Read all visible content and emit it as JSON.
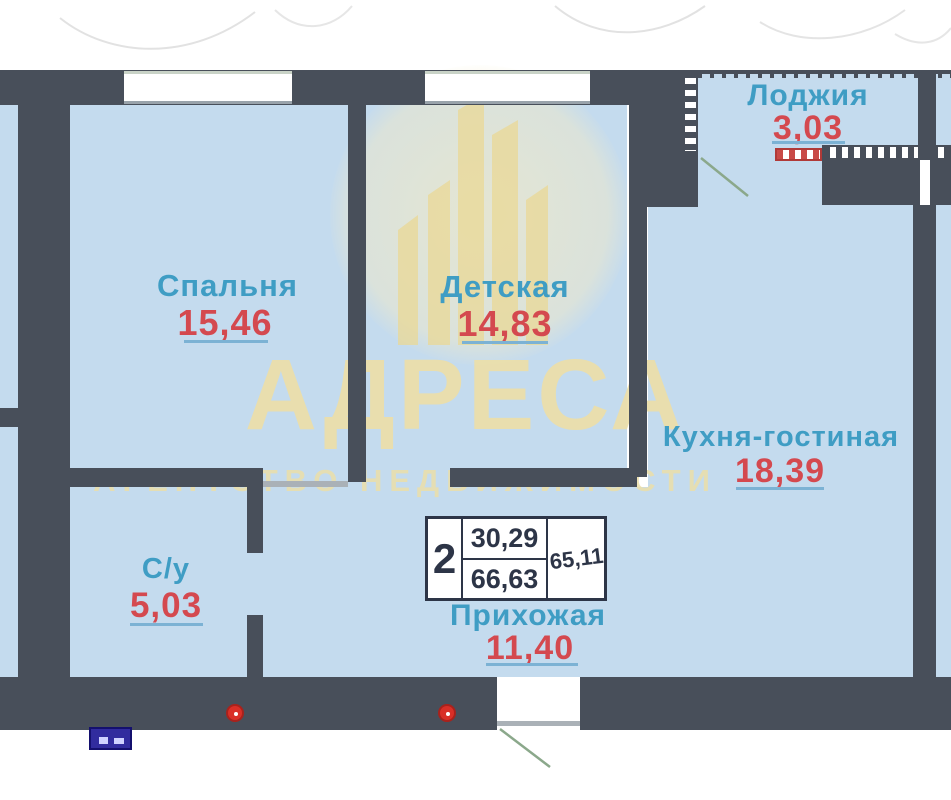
{
  "plan": {
    "rooms": [
      {
        "name": "Спальня",
        "area": "15,46"
      },
      {
        "name": "Детская",
        "area": "14,83"
      },
      {
        "name": "Лоджия",
        "area": "3,03"
      },
      {
        "name": "Кухня-гостиная",
        "area": "18,39"
      },
      {
        "name": "С/у",
        "area": "5,03"
      },
      {
        "name": "Прихожая",
        "area": "11,40"
      }
    ],
    "stamp": {
      "rooms_count": "2",
      "area_top": "30,29",
      "area_bottom": "66,63",
      "area_right": "65,11"
    },
    "watermark": {
      "title": "АДРЕСА",
      "subtitle": "АГЕНТСТВО НЕДВИЖИМОСТИ"
    },
    "colors": {
      "wall": "#484f5a",
      "room_fill": "#c4dbee",
      "label_blue": "#3f9dc4",
      "area_red": "#d4494f",
      "underline_blue": "#7cb2d4",
      "watermark_gold": "#ebdea8",
      "door_swing_green": "#8ba88b",
      "marker_red": "#d92f27",
      "panel_navy": "#312c9e"
    }
  }
}
